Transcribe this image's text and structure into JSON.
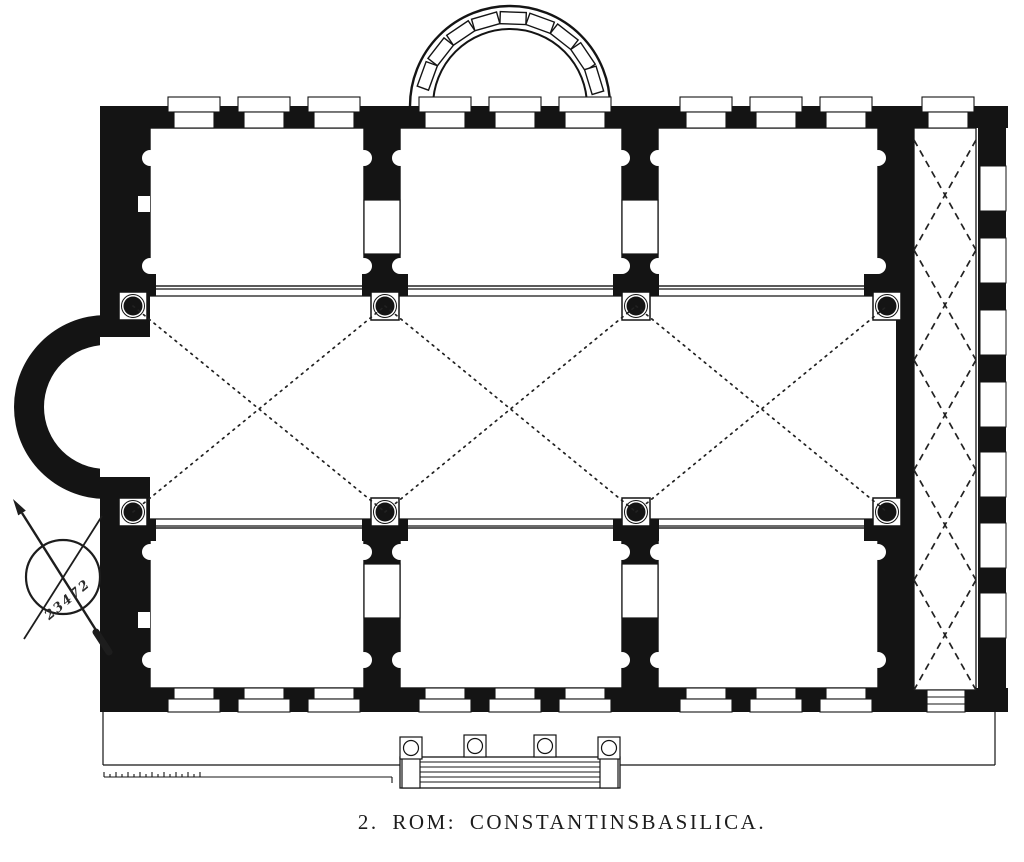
{
  "figure": {
    "caption": "2. ROM: CONSTANTINSBASILICA.",
    "handwritten_note": "23472"
  },
  "colors": {
    "ink": "#141414",
    "paper": "#ffffff"
  },
  "icons": {
    "compass": "compass-rose-icon"
  }
}
